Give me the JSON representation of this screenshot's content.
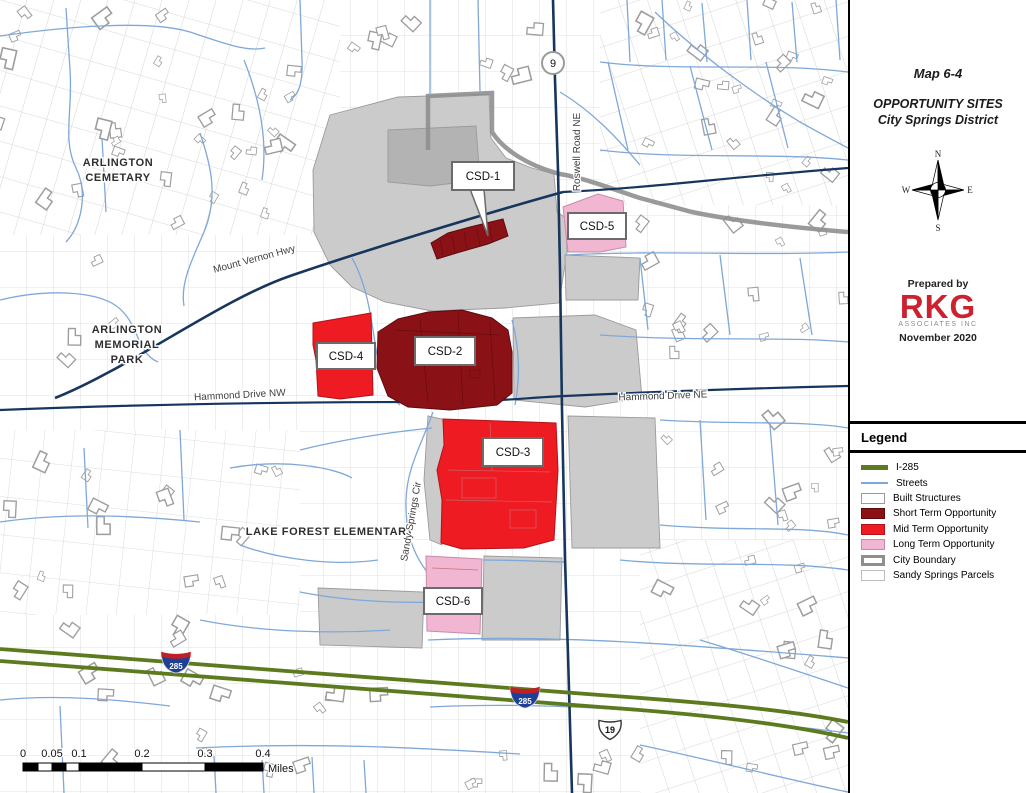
{
  "panel": {
    "map_number": "Map 6-4",
    "title_line1": "OPPORTUNITY SITES",
    "title_line2": "City Springs District",
    "compass": {
      "n": "N",
      "e": "E",
      "s": "S",
      "w": "W"
    },
    "credit": {
      "prepared_by": "Prepared by",
      "logo": "RKG",
      "logo_sub": "ASSOCIATES INC",
      "date": "November 2020"
    }
  },
  "legend": {
    "title": "Legend",
    "items": [
      {
        "label": "I-285",
        "swatch": "line",
        "color": "#5d7a1e"
      },
      {
        "label": "Streets",
        "swatch": "line",
        "color": "#7fa8d9"
      },
      {
        "label": "Built Structures",
        "swatch": "box",
        "color": "#ffffff",
        "border": "#9a9a9a"
      },
      {
        "label": "Short Term Opportunity",
        "swatch": "box",
        "color": "#8a1216"
      },
      {
        "label": "Mid Term Opportunity",
        "swatch": "box",
        "color": "#ee1b23"
      },
      {
        "label": "Long Term Opportunity",
        "swatch": "box",
        "color": "#f1b6d2"
      },
      {
        "label": "City Boundary",
        "swatch": "box-thick-border",
        "color": "#ffffff",
        "border": "#8f8f8f"
      },
      {
        "label": "Sandy Springs Parcels",
        "swatch": "box",
        "color": "#ffffff",
        "border": "#bdbdbd"
      }
    ]
  },
  "map": {
    "sites": [
      {
        "id": "CSD-1",
        "term": "Short Term Opportunity"
      },
      {
        "id": "CSD-2",
        "term": "Short Term Opportunity"
      },
      {
        "id": "CSD-3",
        "term": "Mid Term Opportunity"
      },
      {
        "id": "CSD-4",
        "term": "Mid Term Opportunity"
      },
      {
        "id": "CSD-5",
        "term": "Long Term Opportunity"
      },
      {
        "id": "CSD-6",
        "term": "Long Term Opportunity"
      }
    ],
    "area_labels": {
      "cemetery": [
        "ARLINGTON",
        "CEMETARY"
      ],
      "memorial_park": [
        "ARLINGTON",
        "MEMORIAL",
        "PARK"
      ],
      "school": [
        "LAKE FOREST ELEMENTARY"
      ]
    },
    "streets": {
      "mount_vernon": "Mount Vernon Hwy",
      "hammond_nw": "Hammond Drive NW",
      "hammond_ne": "Hammond Drive NE",
      "roswell": "Roswell Road NE",
      "sandy_springs": "Sandy Springs Cir"
    },
    "shields": {
      "state_route": "9",
      "interstate": "285",
      "us_route": "19"
    },
    "scale_bar": {
      "ticks": [
        "0",
        "0.05",
        "0.1",
        "0.2",
        "0.3",
        "0.4"
      ],
      "unit": "Miles"
    }
  },
  "colors": {
    "short_term": "#8a1216",
    "mid_term": "#ee1b23",
    "long_term": "#f1b6d2",
    "i285": "#5d7a1e",
    "streets": "#7fa8d9",
    "major_road": "#17365d",
    "built_structures": "#cbcbcb",
    "city_boundary": "#8f8f8f",
    "logo_red": "#cd2130"
  }
}
